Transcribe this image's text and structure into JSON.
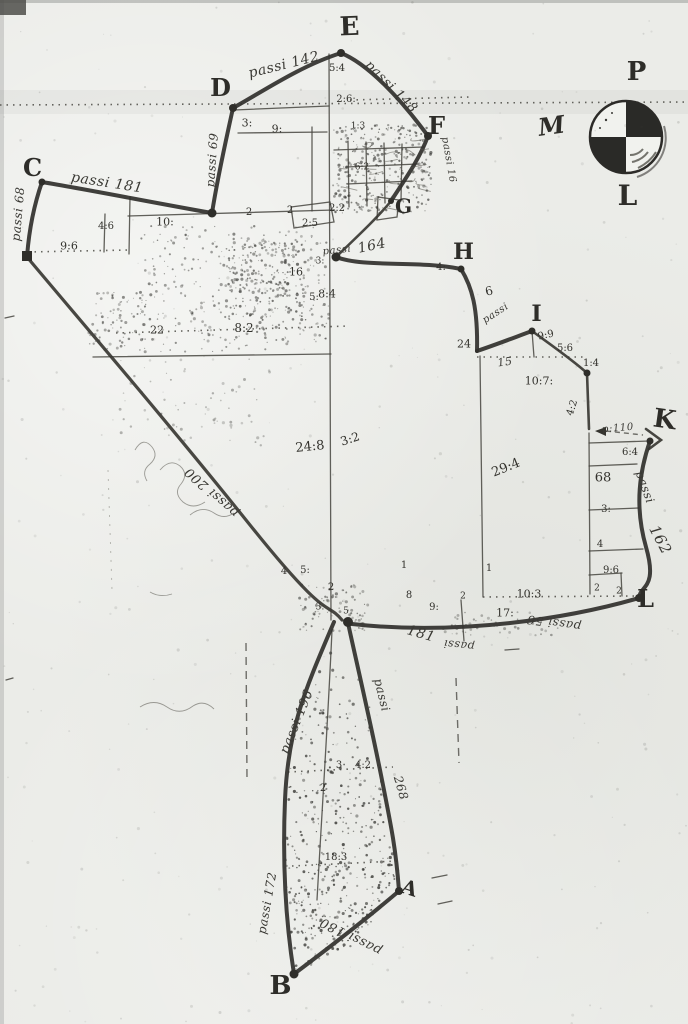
{
  "colors": {
    "paper": "#ebece8",
    "ink": "#31302c"
  },
  "compass": {
    "top": "P",
    "west": "M",
    "south": "L"
  },
  "vertex_labels": [
    {
      "id": "E",
      "x": 350,
      "y": 27,
      "s": 26,
      "r": -2
    },
    {
      "id": "D",
      "x": 221,
      "y": 88,
      "s": 24,
      "r": 0
    },
    {
      "id": "F",
      "x": 437,
      "y": 126,
      "s": 24,
      "r": 0
    },
    {
      "id": "G",
      "x": 404,
      "y": 206,
      "s": 20,
      "r": 0
    },
    {
      "id": "C",
      "x": 33,
      "y": 168,
      "s": 24,
      "r": 0
    },
    {
      "id": "H",
      "x": 464,
      "y": 252,
      "s": 22,
      "r": 0
    },
    {
      "id": "I",
      "x": 537,
      "y": 314,
      "s": 22,
      "r": 0
    },
    {
      "id": "K",
      "x": 665,
      "y": 420,
      "s": 26,
      "r": 8
    },
    {
      "id": "L",
      "x": 646,
      "y": 599,
      "s": 24,
      "r": 0
    },
    {
      "id": "A",
      "x": 410,
      "y": 888,
      "s": 20,
      "r": 18
    },
    {
      "id": "B",
      "x": 281,
      "y": 986,
      "s": 26,
      "r": 0
    },
    {
      "id": "P",
      "x": 637,
      "y": 72,
      "s": 26,
      "r": 0
    },
    {
      "id": "M",
      "x": 552,
      "y": 126,
      "s": 24,
      "r": -8,
      "it": true
    },
    {
      "id": "L",
      "x": 628,
      "y": 196,
      "s": 28,
      "r": 0
    }
  ],
  "measure_labels": [
    {
      "t": "passi 142",
      "x": 284,
      "y": 65,
      "r": -14,
      "s": 14
    },
    {
      "t": "passi 148",
      "x": 391,
      "y": 87,
      "r": 45,
      "s": 13
    },
    {
      "t": "passi 69",
      "x": 212,
      "y": 160,
      "r": -86,
      "s": 12
    },
    {
      "t": "passi 181",
      "x": 107,
      "y": 183,
      "r": 9,
      "s": 14
    },
    {
      "t": "passi 68",
      "x": 18,
      "y": 214,
      "r": -85,
      "s": 12
    },
    {
      "t": "passi",
      "x": 337,
      "y": 251,
      "r": -6,
      "s": 10
    },
    {
      "t": "passi",
      "x": 496,
      "y": 314,
      "r": -33,
      "s": 10
    },
    {
      "t": "p:110",
      "x": 618,
      "y": 429,
      "r": -5,
      "s": 10
    },
    {
      "t": "passi",
      "x": 645,
      "y": 487,
      "r": 70,
      "s": 12
    },
    {
      "t": "162",
      "x": 660,
      "y": 540,
      "r": 62,
      "s": 15
    },
    {
      "t": "passi 56",
      "x": 554,
      "y": 623,
      "r": 188,
      "s": 12
    },
    {
      "t": "passi",
      "x": 459,
      "y": 645,
      "r": 186,
      "s": 11
    },
    {
      "t": "181",
      "x": 421,
      "y": 634,
      "r": 16,
      "s": 14
    },
    {
      "t": "passi 200",
      "x": 212,
      "y": 492,
      "r": 222,
      "s": 13
    },
    {
      "t": "passi 196",
      "x": 297,
      "y": 722,
      "r": -68,
      "s": 13
    },
    {
      "t": "passi",
      "x": 382,
      "y": 695,
      "r": 76,
      "s": 12
    },
    {
      "t": "268",
      "x": 401,
      "y": 788,
      "r": 74,
      "s": 12
    },
    {
      "t": "passi 172",
      "x": 267,
      "y": 903,
      "r": -80,
      "s": 12
    },
    {
      "t": "passi 180",
      "x": 351,
      "y": 936,
      "r": 207,
      "s": 13
    },
    {
      "t": "passi 16",
      "x": 448,
      "y": 160,
      "r": 80,
      "s": 10
    },
    {
      "t": "164",
      "x": 372,
      "y": 246,
      "r": -12,
      "s": 14
    },
    {
      "t": "15",
      "x": 505,
      "y": 362,
      "r": -8,
      "s": 11
    }
  ],
  "number_labels": [
    {
      "t": "3:",
      "x": 247,
      "y": 123,
      "s": 11
    },
    {
      "t": "9:",
      "x": 277,
      "y": 129,
      "s": 11
    },
    {
      "t": "5:4",
      "x": 337,
      "y": 69,
      "s": 10
    },
    {
      "t": "2:6:",
      "x": 346,
      "y": 100,
      "s": 10
    },
    {
      "t": "1:3",
      "x": 358,
      "y": 127,
      "s": 9
    },
    {
      "t": "6:2",
      "x": 362,
      "y": 168,
      "s": 9
    },
    {
      "t": "2",
      "x": 290,
      "y": 211,
      "s": 10
    },
    {
      "t": "2:5",
      "x": 310,
      "y": 224,
      "s": 10
    },
    {
      "t": "2:2",
      "x": 337,
      "y": 209,
      "s": 10
    },
    {
      "t": "10:",
      "x": 165,
      "y": 222,
      "s": 11
    },
    {
      "t": "2",
      "x": 249,
      "y": 213,
      "s": 10
    },
    {
      "t": "4:6",
      "x": 106,
      "y": 227,
      "s": 10
    },
    {
      "t": "9:6",
      "x": 69,
      "y": 246,
      "s": 11
    },
    {
      "t": "16",
      "x": 296,
      "y": 272,
      "s": 11
    },
    {
      "t": "5:",
      "x": 314,
      "y": 298,
      "s": 10
    },
    {
      "t": "8:4",
      "x": 327,
      "y": 294,
      "s": 11
    },
    {
      "t": "3:",
      "x": 320,
      "y": 262,
      "s": 9
    },
    {
      "t": "22",
      "x": 157,
      "y": 330,
      "s": 11
    },
    {
      "t": "8:2",
      "x": 244,
      "y": 328,
      "s": 12
    },
    {
      "t": "4:",
      "x": 441,
      "y": 268,
      "s": 10
    },
    {
      "t": "6",
      "x": 489,
      "y": 291,
      "s": 12,
      "r": -15
    },
    {
      "t": "24",
      "x": 464,
      "y": 344,
      "s": 11
    },
    {
      "t": "9:9",
      "x": 546,
      "y": 336,
      "s": 10,
      "r": -12
    },
    {
      "t": "5:6",
      "x": 565,
      "y": 349,
      "s": 10
    },
    {
      "t": "1:4",
      "x": 591,
      "y": 364,
      "s": 10
    },
    {
      "t": "10:7:",
      "x": 539,
      "y": 381,
      "s": 11
    },
    {
      "t": "4:2",
      "x": 573,
      "y": 408,
      "s": 10,
      "r": -72
    },
    {
      "t": "6:4",
      "x": 630,
      "y": 453,
      "s": 10
    },
    {
      "t": "68",
      "x": 603,
      "y": 478,
      "s": 13
    },
    {
      "t": "3:",
      "x": 606,
      "y": 510,
      "s": 10
    },
    {
      "t": "4",
      "x": 600,
      "y": 545,
      "s": 10
    },
    {
      "t": "9:6",
      "x": 611,
      "y": 571,
      "s": 10
    },
    {
      "t": "2",
      "x": 597,
      "y": 589,
      "s": 9
    },
    {
      "t": "2",
      "x": 619,
      "y": 592,
      "s": 9
    },
    {
      "t": "10:3",
      "x": 529,
      "y": 594,
      "s": 11
    },
    {
      "t": "17:",
      "x": 505,
      "y": 613,
      "s": 11
    },
    {
      "t": "1",
      "x": 489,
      "y": 569,
      "s": 10
    },
    {
      "t": "8",
      "x": 409,
      "y": 596,
      "s": 10
    },
    {
      "t": "9:",
      "x": 434,
      "y": 608,
      "s": 10
    },
    {
      "t": "2",
      "x": 463,
      "y": 597,
      "s": 9
    },
    {
      "t": "24:8",
      "x": 310,
      "y": 447,
      "s": 13,
      "r": -6
    },
    {
      "t": "3:2",
      "x": 350,
      "y": 439,
      "s": 12,
      "r": -18
    },
    {
      "t": "29:4",
      "x": 506,
      "y": 468,
      "s": 13,
      "r": -22
    },
    {
      "t": "5:",
      "x": 305,
      "y": 571,
      "s": 10
    },
    {
      "t": "4",
      "x": 284,
      "y": 572,
      "s": 10
    },
    {
      "t": "2",
      "x": 331,
      "y": 588,
      "s": 10
    },
    {
      "t": "1",
      "x": 404,
      "y": 566,
      "s": 10
    },
    {
      "t": "3:",
      "x": 320,
      "y": 608,
      "s": 9
    },
    {
      "t": "5",
      "x": 346,
      "y": 612,
      "s": 9
    },
    {
      "t": "3",
      "x": 339,
      "y": 766,
      "s": 10
    },
    {
      "t": "4:2",
      "x": 363,
      "y": 766,
      "s": 10
    },
    {
      "t": "2",
      "x": 323,
      "y": 789,
      "s": 10
    },
    {
      "t": "18:3",
      "x": 336,
      "y": 858,
      "s": 10
    }
  ]
}
